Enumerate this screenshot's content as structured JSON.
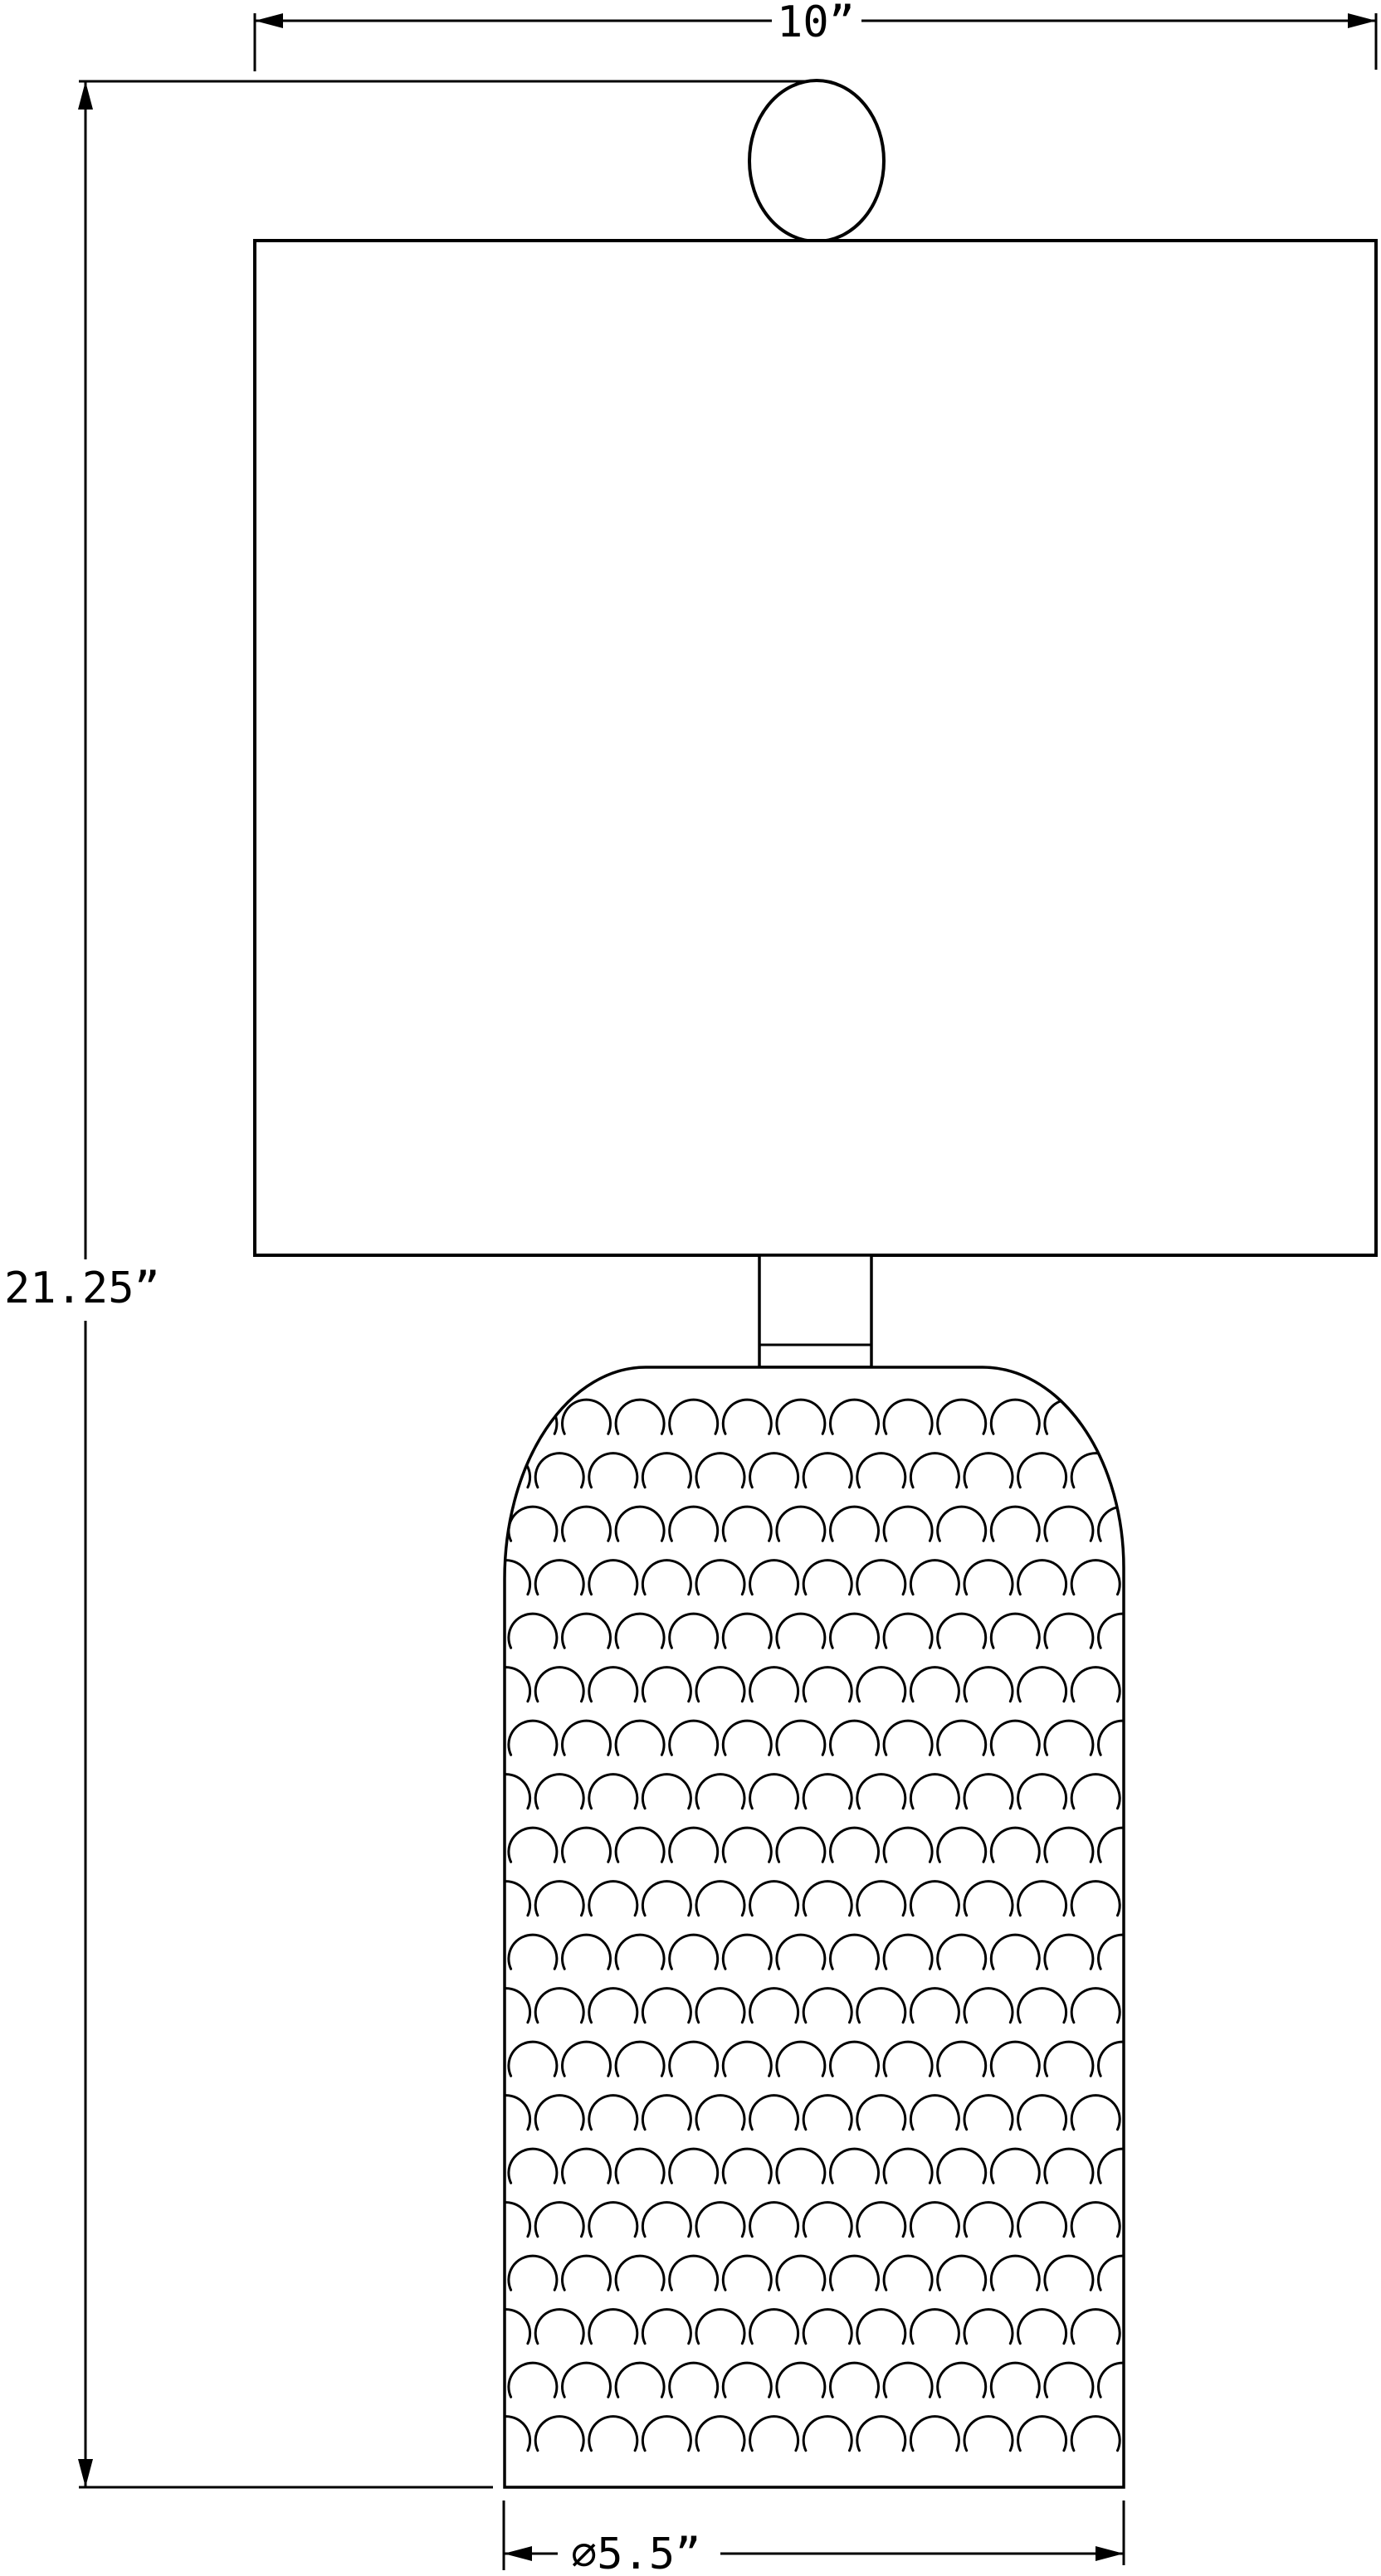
{
  "drawing": {
    "description": "Table lamp dimensioned line drawing",
    "colors": {
      "line": "#000000",
      "background": "#ffffff"
    },
    "dimensions": {
      "shade_width": {
        "label": "10”",
        "value_inches": 10
      },
      "overall_height": {
        "label": "21.25”",
        "value_inches": 21.25
      },
      "base_diameter": {
        "label": "⌀5.5”",
        "value_inches": 5.5
      }
    }
  }
}
